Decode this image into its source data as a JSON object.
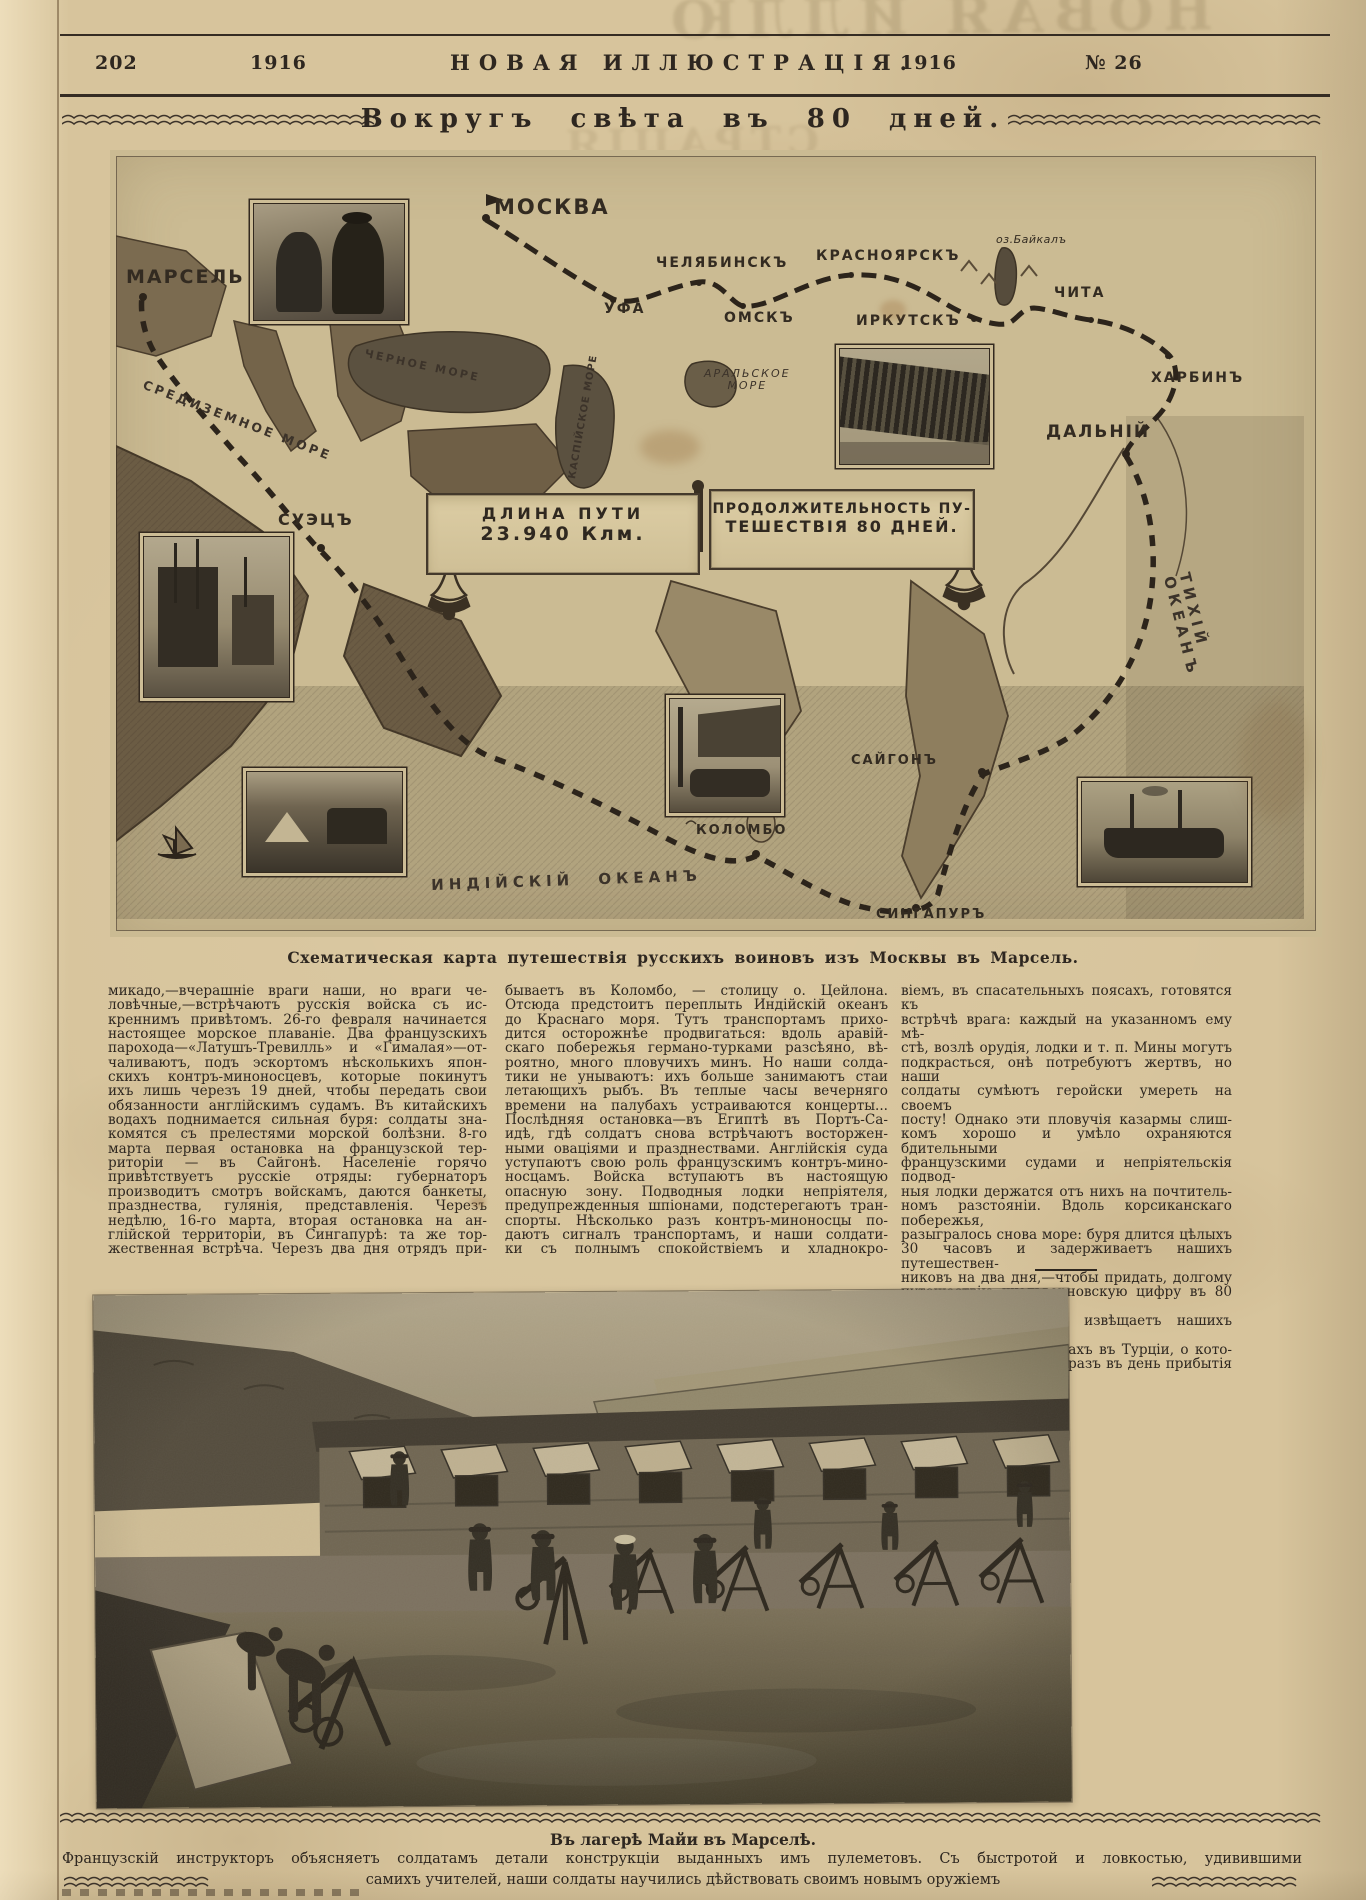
{
  "palette": {
    "paper": "#d7c49c",
    "ink": "#2e2720",
    "map_paper": "#cbbb93",
    "photo_dark": "#3b352c"
  },
  "header": {
    "page_number": "202",
    "year_left": "1916",
    "masthead": "НОВАЯ ИЛЛЮСТРАЦІЯ.",
    "year_right": "1916",
    "issue": "№ 26"
  },
  "title": "Вокругъ свѣта въ 80 дней.",
  "map": {
    "labels": {
      "moscow": "МОСКВА",
      "marseille": "МАРСЕЛЬ",
      "ufa": "УФА",
      "chelyabinsk": "ЧЕЛЯБИНСКЪ",
      "omsk": "ОМСКЪ",
      "krasnoyarsk": "КРАСНОЯРСКЪ",
      "irkutsk": "ИРКУТСКЪ",
      "baikal": "оз.Байкалъ",
      "chita": "ЧИТА",
      "harbin": "ХАРБИНЪ",
      "dalny": "ДАЛЬНІЙ",
      "suez": "СУЭЦЪ",
      "saigon": "САЙГОНЪ",
      "colombo": "КОЛОМБО",
      "singapore": "СИНГАПУРЪ",
      "black_sea": "ЧЕРНОЕ МОРЕ",
      "mediterranean": "СРЕДИЗЕМНОЕ МОРЕ",
      "caspian_sea": "КАСПІЙСКОЕ МОРЕ",
      "aral_sea": "АРАЛЬСКОЕ\nМОРЕ",
      "indian_ocean": "ИНДІЙСКІЙ ОКЕАНЪ",
      "pacific_ocean": "ТИХІЙ ОКЕАНЪ"
    },
    "banner_length": {
      "line1": "ДЛИНА ПУТИ",
      "line2": "23.940 Клм."
    },
    "banner_duration": {
      "line1": "ПРОДОЛЖИТЕЛЬНОСТЬ ПУ-",
      "line2": "ТЕШЕСТВІЯ 80 ДНЕЙ."
    },
    "caption": "Схематическая карта путешествія русскихъ воиновъ изъ Москвы въ Марсель."
  },
  "article": {
    "col1": [
      "микадо,—вчерашніе враги наши, но враги че-",
      "ловѣчные,—встрѣчаютъ русскія войска съ ис-",
      "креннимъ привѣтомъ. 26-го февраля начинается",
      "настоящее морское плаваніе. Два французскихъ",
      "парохода—«Латушъ-Тревилль» и «Гималая»—от-",
      "чаливаютъ, подъ эскортомъ нѣсколькихъ япон-",
      "скихъ контръ-миноносцевъ, которые покинутъ",
      "ихъ лишь черезъ 19 дней, чтобы передать свои",
      "обязанности англійскимъ судамъ. Въ китайскихъ",
      "водахъ поднимается сильная буря: солдаты зна-",
      "комятся съ прелестями морской болѣзни. 8-го",
      "марта первая остановка на французской тер-",
      "риторіи — въ Сайгонѣ. Населеніе горячо",
      "привѣтствуетъ русскіе отряды: губернаторъ",
      "производитъ смотръ войскамъ, даются банкеты,",
      "празднества, гулянія, представленія. Черезъ",
      "недѣлю, 16-го марта, вторая остановка на ан-",
      "глійской территоріи, въ Сингапурѣ: та же тор-",
      "жественная встрѣча. Черезъ два дня отрядъ при-"
    ],
    "col2": [
      "бываетъ въ Коломбо, — столицу о. Цейлона.",
      "Отсюда предстоитъ переплыть Индійскій океанъ",
      "до Краснаго моря. Тутъ транспортамъ прихо-",
      "дится осторожнѣе продвигаться: вдоль аравій-",
      "скаго побережья германо-турками разсѣяно, вѣ-",
      "роятно, много пловучихъ минъ. Но наши солда-",
      "тики не унываютъ: ихъ больше занимаютъ стаи",
      "летающихъ рыбъ. Въ теплые часы вечерняго",
      "времени на палубахъ устраиваются концерты...",
      "Послѣдняя остановка—въ Египтѣ въ Портъ-Са-",
      "идѣ, гдѣ солдатъ снова встрѣчаютъ восторжен-",
      "ными оваціями и празднествами. Англійскія суда",
      "уступаютъ свою роль французскимъ контръ-мино-",
      "носцамъ. Войска вступаютъ въ настоящую",
      "опасную зону. Подводныя лодки непріятеля,",
      "предупрежденныя шпіонами, подстерегаютъ тран-",
      "спорты. Нѣсколько разъ контръ-миноносцы по-",
      "даютъ сигналъ транспортамъ, и наши солдати-",
      "ки съ полнымъ спокойствіемъ и хладнокро-"
    ],
    "col3": [
      "віемъ, въ спасательныхъ поясахъ, готовятся къ",
      "встрѣчѣ врага: каждый на указанномъ ему мѣ-",
      "стѣ, возлѣ орудія, лодки и т. п. Мины могутъ",
      "подкрасться, онѣ потребуютъ жертвъ, но наши",
      "солдаты сумѣютъ геройски умереть на своемъ",
      "посту! Однако эти пловучія казармы слиш-",
      "комъ хорошо и умѣло охраняются бдительными",
      "французскими судами и непріятельскія подвод-",
      "ныя лодки держатся отъ нихъ на почтитель-",
      "номъ разстояніи. Вдоль корсиканскаго побережья,",
      "разыгралось снова море: буря длится цѣлыхъ",
      "30 часовъ и задерживаетъ нашихъ путешествен-",
      "никовъ на два дня,—чтобы придать, долгому",
      "путешествію жюльверновскую цифру въ 80 дней.",
      "Крикъ «Трапезондъ!» извѣщаетъ нашихъ вои-",
      "новъ о русскихъ успѣхахъ въ Турціи, о кото-",
      "рыхъ они узнали какъ разъ въ день прибытія",
      "въ марсельскій портъ."
    ]
  },
  "photo": {
    "caption_title": "Въ лагерѣ Майи въ Марселѣ.",
    "caption_line1": "Французскій инструкторъ объясняетъ солдатамъ детали конструкціи выданныхъ имъ пулеметовъ. Съ быстротой и ловкостью, удивившими",
    "caption_line2": "самихъ учителей, наши солдаты научились дѣйствовать своимъ новымъ оружіемъ"
  }
}
